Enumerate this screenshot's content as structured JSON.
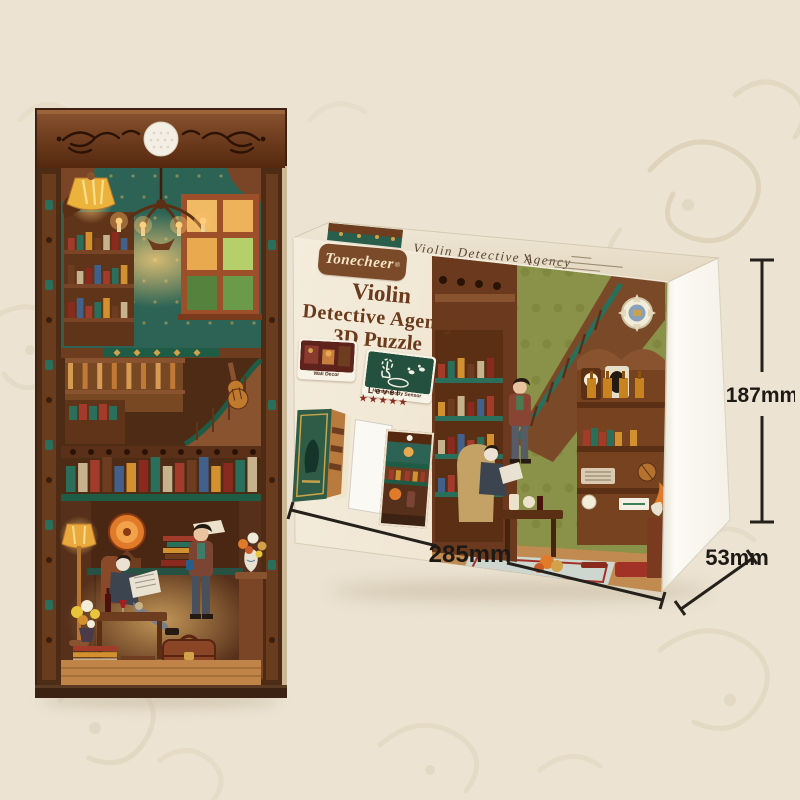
{
  "product": {
    "brand": "Tonecheer",
    "brand_reg": "®",
    "name": "Violin Detective Agency 3D Puzzle"
  },
  "box_top": {
    "script_title": "Violin Detective Agency"
  },
  "box_front": {
    "title_line1": "Violin",
    "title_line2": "Detective Agency",
    "title_line3": "3D Puzzle",
    "features": [
      {
        "label": "Wall Decor"
      },
      {
        "label": "Human Body Sensor"
      }
    ],
    "level_label": "Level",
    "level_stars": "★★★★★"
  },
  "dimensions": {
    "width": "285mm",
    "depth": "53mm",
    "height": "187mm"
  },
  "colors": {
    "background": "#ece3d2",
    "box_cream": "#f2ead9",
    "brand_brown": "#7b4a28",
    "title_brown": "#6b3a1c",
    "accent_teal": "#2a6e5c",
    "wallpaper_green": "#8a9148",
    "star_red": "#8a2a1e",
    "dimension_ink": "#24201b"
  }
}
